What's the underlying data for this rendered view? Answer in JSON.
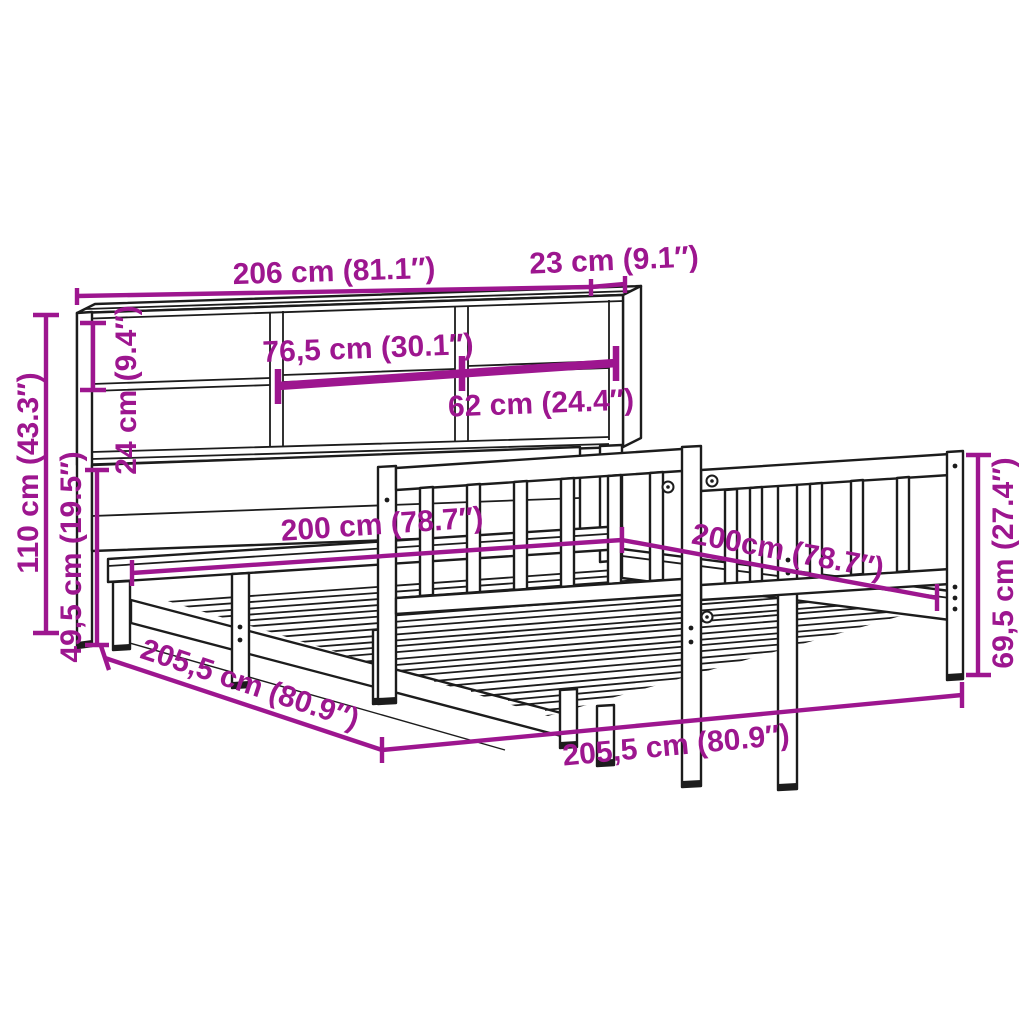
{
  "diagram": {
    "type": "product-dimension-diagram",
    "units": [
      "cm",
      "inches"
    ],
    "dims": {
      "overall_width": "206 cm (81.1″)",
      "top_depth": "23 cm (9.1″)",
      "shelf_center_width": "76,5 cm (30.1″)",
      "shelf_right_width": "62 cm (24.4″)",
      "top_section_height": "24 cm (9.4″)",
      "headboard_height": "110 cm (43.3″)",
      "headboard_lower_height": "49,5 cm (19.5″)",
      "mattress_width": "200 cm (78.7″)",
      "mattress_length": "200cm (78.7″)",
      "footboard_height": "69,5 cm (27.4″)",
      "frame_length_side": "205,5 cm (80.9″)",
      "frame_width_front": "205,5 cm (80.9″)"
    },
    "colors": {
      "dimension": "#9d168f",
      "line": "#1c1c1c",
      "background": "#ffffff"
    }
  }
}
